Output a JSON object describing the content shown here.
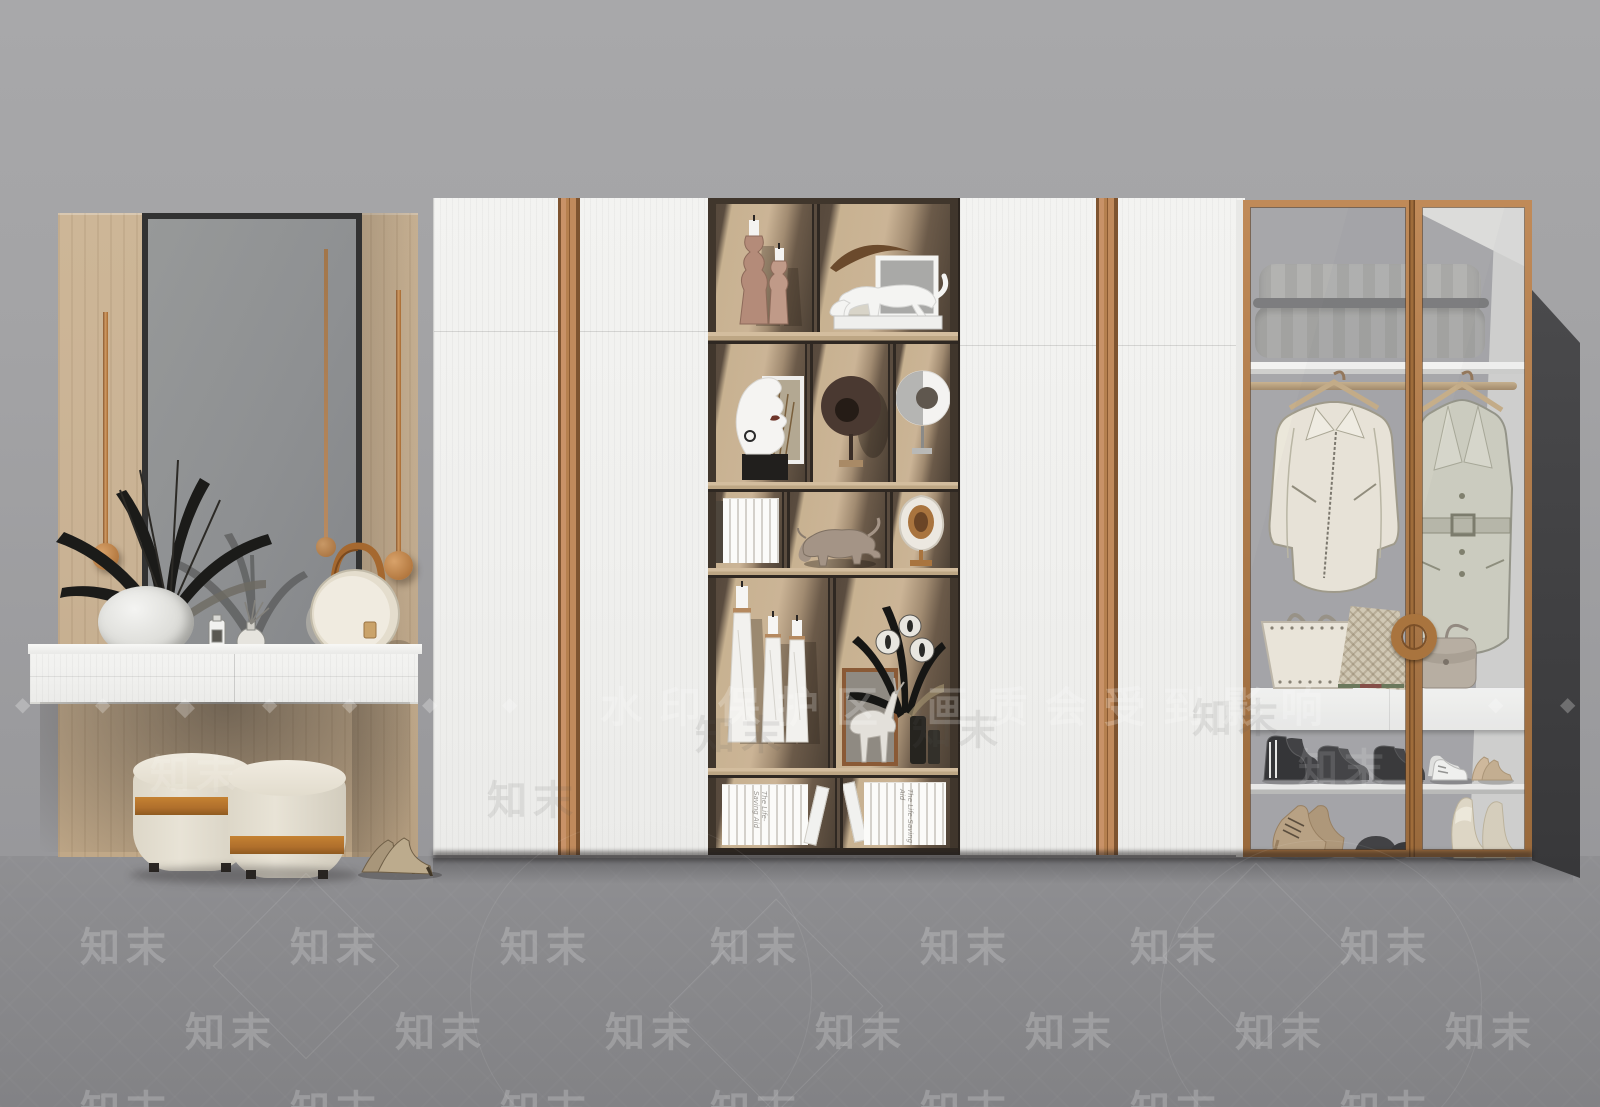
{
  "watermark": {
    "brand": "知末",
    "protect_text": "水印保护区 画质会受到影响",
    "diamond": "◆"
  },
  "books": {
    "spine_text": "The Life-Saving Aid"
  },
  "palette": {
    "wall": "#a3a3a5",
    "wall-lower": "#98989b",
    "floor": "#8a8a8d",
    "floor-front": "#828285",
    "door-white": "#f0f0ee",
    "copper": "#b5804f",
    "copper-dark": "#7c5028",
    "wood": "#c9b294",
    "dark-wood": "#453a2f",
    "shelf-back": "#c6b08f",
    "mirror": "#8f9193",
    "mirror-frame": "#323232",
    "pouf": "#e8e3d6",
    "pouf-band": "#b06f2c",
    "duvet": "#aaaaa8",
    "closet-gray": "#9d9da0",
    "jacket": "#e9e4d6",
    "coat": "#c9c9bb",
    "shadow": "#3d3d3f",
    "wm": "rgba(255,255,255,0.20)",
    "wm-dark": "rgba(90,90,94,0.12)"
  }
}
